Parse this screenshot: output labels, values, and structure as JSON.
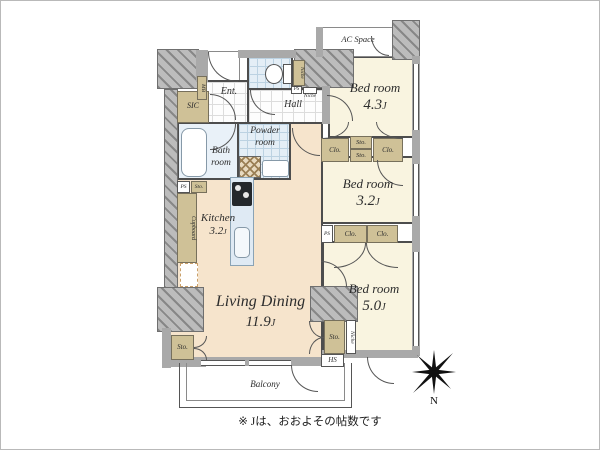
{
  "note": "※ Jは、おおよその帖数です",
  "compass": {
    "label": "N"
  },
  "labels": {
    "closet": "Clo.",
    "storage": "Sto.",
    "pipe_space": "PS",
    "hs": "HS",
    "niche": "Niche",
    "meter_box": "MB",
    "cupboard": "Cupboard",
    "j_unit": "J"
  },
  "rooms": {
    "living_dining": {
      "name": "Living Dining",
      "size": "11.9"
    },
    "kitchen": {
      "name": "Kitchen",
      "size": "3.2"
    },
    "bedroom_43": {
      "name": "Bed room",
      "size": "4.3"
    },
    "bedroom_32": {
      "name": "Bed room",
      "size": "3.2"
    },
    "bedroom_50": {
      "name": "Bed room",
      "size": "5.0"
    },
    "bath": {
      "name": "Bath room"
    },
    "powder": {
      "name": "Powder room"
    },
    "entrance": {
      "name": "Ent."
    },
    "hall": {
      "name": "Hall"
    },
    "sic": {
      "name": "SIC"
    },
    "balcony": {
      "name": "Balcony"
    },
    "ac_space": {
      "name": "AC Space"
    }
  }
}
